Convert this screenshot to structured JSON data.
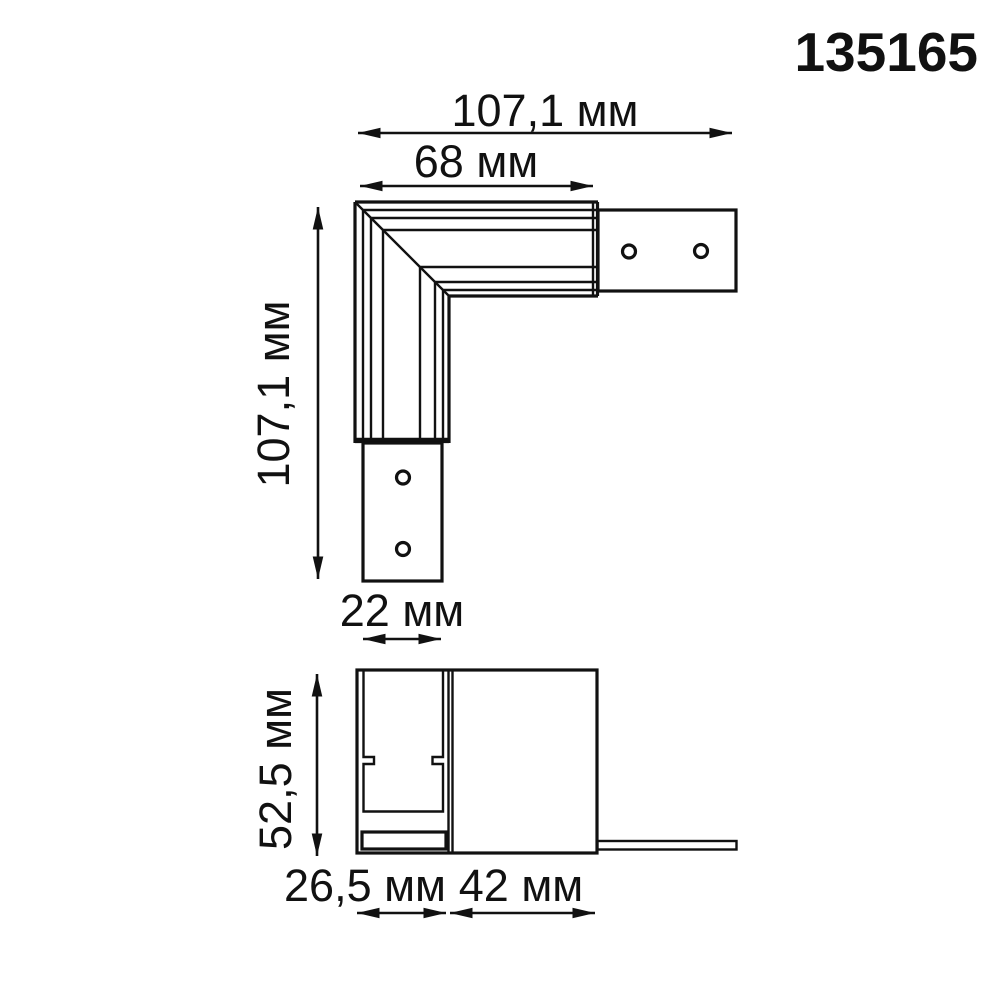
{
  "product_code": "135165",
  "colors": {
    "line": "#111111",
    "background": "#ffffff"
  },
  "top_view": {
    "dim_overall_width": "107,1 мм",
    "dim_profile_length": "68 мм",
    "dim_overall_height": "107,1 мм",
    "dim_tab_width": "22 мм"
  },
  "side_view": {
    "dim_height": "52,5 мм",
    "dim_channel_width": "26,5 мм",
    "dim_body_width": "42 мм"
  }
}
